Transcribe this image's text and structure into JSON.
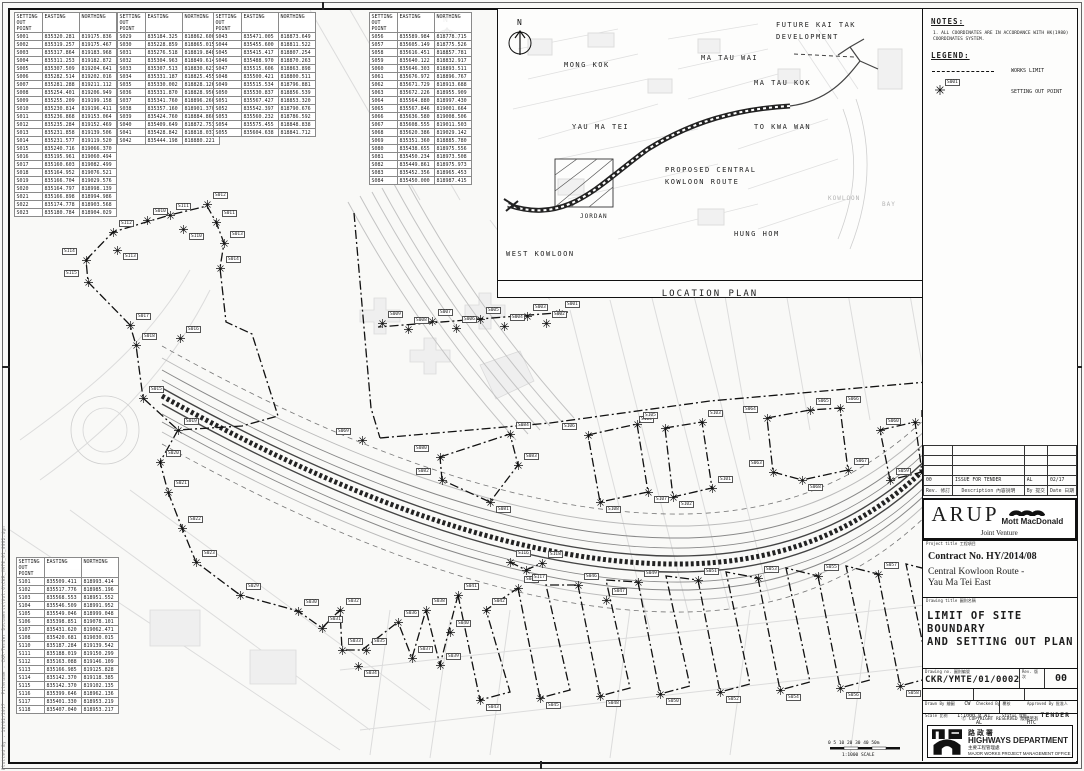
{
  "sheet": {
    "plot_info_line1": "Plotted By : 16/02/2017",
    "plot_info_line2": "Filename : CKR-Tender Documents\\Vol.6\\CKR_YMTE_01_0002.dgn",
    "north_label": "N",
    "scale_bar_ticks": "0  5  10   20   30   40   50m",
    "scale_bar_label": "1:1000  SCALE"
  },
  "tables": {
    "headers": [
      "SETTING OUT POINT",
      "EASTING",
      "NORTHING"
    ],
    "t1": {
      "rows": [
        [
          "S001",
          "835320.281",
          "819175.836"
        ],
        [
          "S002",
          "835319.257",
          "819175.467"
        ],
        [
          "S003",
          "835317.864",
          "819183.968"
        ],
        [
          "S004",
          "835311.253",
          "819182.872"
        ],
        [
          "S005",
          "835307.509",
          "819204.641"
        ],
        [
          "S006",
          "835282.514",
          "819202.016"
        ],
        [
          "S007",
          "835281.288",
          "819211.112"
        ],
        [
          "S008",
          "835254.401",
          "819206.949"
        ],
        [
          "S009",
          "835255.209",
          "819199.158"
        ],
        [
          "S010",
          "835230.814",
          "819196.411"
        ],
        [
          "S011",
          "835236.868",
          "819153.064"
        ],
        [
          "S012",
          "835235.284",
          "819152.469"
        ],
        [
          "S013",
          "835231.858",
          "819139.506"
        ],
        [
          "S014",
          "835231.577",
          "819119.520"
        ],
        [
          "S015",
          "835240.716",
          "819066.370"
        ],
        [
          "S016",
          "835195.961",
          "819060.494"
        ],
        [
          "S017",
          "835160.603",
          "819082.499"
        ],
        [
          "S018",
          "835164.952",
          "819076.521"
        ],
        [
          "S019",
          "835166.704",
          "819029.576"
        ],
        [
          "S020",
          "835164.797",
          "818998.139"
        ],
        [
          "S021",
          "835166.898",
          "818994.986"
        ],
        [
          "S022",
          "835174.778",
          "818903.568"
        ],
        [
          "S023",
          "835180.784",
          "818904.029"
        ]
      ]
    },
    "t2": {
      "rows": [
        [
          "S029",
          "835184.325",
          "818862.600"
        ],
        [
          "S030",
          "835228.859",
          "818865.015"
        ],
        [
          "S031",
          "835276.518",
          "818819.848"
        ],
        [
          "S032",
          "835304.963",
          "818849.614"
        ],
        [
          "S033",
          "835307.513",
          "818830.623"
        ],
        [
          "S034",
          "835331.187",
          "818825.455"
        ],
        [
          "S035",
          "835330.002",
          "818828.126"
        ],
        [
          "S036",
          "835331.870",
          "818828.956"
        ],
        [
          "S037",
          "835341.760",
          "818896.260"
        ],
        [
          "S038",
          "835357.160",
          "818901.370"
        ],
        [
          "S039",
          "835424.760",
          "818884.860"
        ],
        [
          "S040",
          "835409.649",
          "818872.753"
        ],
        [
          "S041",
          "835428.842",
          "818818.037"
        ],
        [
          "S042",
          "835444.198",
          "818880.221"
        ]
      ]
    },
    "t3": {
      "rows": [
        [
          "S043",
          "835471.005",
          "818873.649"
        ],
        [
          "S044",
          "835455.600",
          "818811.522"
        ],
        [
          "S045",
          "835415.417",
          "818807.254"
        ],
        [
          "S046",
          "835488.970",
          "818870.263"
        ],
        [
          "S047",
          "835515.606",
          "818863.898"
        ],
        [
          "S048",
          "835500.421",
          "818800.511"
        ],
        [
          "S049",
          "835515.534",
          "818796.881"
        ],
        [
          "S050",
          "835530.837",
          "818856.539"
        ],
        [
          "S051",
          "835567.427",
          "818853.320"
        ],
        [
          "S052",
          "835542.397",
          "818790.676"
        ],
        [
          "S053",
          "835560.232",
          "818786.592"
        ],
        [
          "S054",
          "835575.455",
          "818848.838"
        ],
        [
          "S055",
          "835604.638",
          "818841.712"
        ]
      ]
    },
    "t4": {
      "rows": [
        [
          "S056",
          "835589.984",
          "818778.715"
        ],
        [
          "S057",
          "835605.149",
          "818775.526"
        ],
        [
          "S058",
          "835616.451",
          "818857.781"
        ],
        [
          "S059",
          "835640.122",
          "818832.917"
        ],
        [
          "S060",
          "835646.303",
          "818893.511"
        ],
        [
          "S061",
          "835676.972",
          "818896.767"
        ],
        [
          "S062",
          "835671.729",
          "818913.688"
        ],
        [
          "S063",
          "835672.226",
          "818955.909"
        ],
        [
          "S064",
          "835564.880",
          "818997.430"
        ],
        [
          "S065",
          "835567.846",
          "819001.664"
        ],
        [
          "S066",
          "835636.580",
          "819008.506"
        ],
        [
          "S067",
          "835608.555",
          "819011.503"
        ],
        [
          "S068",
          "835620.386",
          "819029.142"
        ],
        [
          "S069",
          "835351.360",
          "818885.780"
        ],
        [
          "S080",
          "835438.655",
          "818975.556"
        ],
        [
          "S081",
          "835450.234",
          "818973.508"
        ],
        [
          "S082",
          "835449.861",
          "818975.973"
        ],
        [
          "S083",
          "835452.356",
          "818965.453"
        ],
        [
          "S084",
          "835450.000",
          "818987.415"
        ]
      ]
    },
    "t5": {
      "rows": [
        [
          "S101",
          "835509.411",
          "818993.414"
        ],
        [
          "S102",
          "835517.776",
          "818985.196"
        ],
        [
          "S103",
          "835568.553",
          "818951.552"
        ],
        [
          "S104",
          "835546.509",
          "818991.952"
        ],
        [
          "S105",
          "835549.046",
          "818999.048"
        ],
        [
          "S106",
          "835398.851",
          "819078.101"
        ],
        [
          "S107",
          "835431.620",
          "819062.471"
        ],
        [
          "S108",
          "835420.681",
          "819030.015"
        ],
        [
          "S110",
          "835187.284",
          "819139.542"
        ],
        [
          "S111",
          "835188.019",
          "819150.299"
        ],
        [
          "S112",
          "835163.088",
          "819146.109"
        ],
        [
          "S113",
          "835166.985",
          "819125.828"
        ],
        [
          "S114",
          "835142.370",
          "819118.385"
        ],
        [
          "S115",
          "835142.370",
          "819102.135"
        ],
        [
          "S116",
          "835399.646",
          "818962.136"
        ],
        [
          "S117",
          "835401.330",
          "818953.219"
        ],
        [
          "S118",
          "835407.040",
          "818953.217"
        ]
      ]
    }
  },
  "location_plan": {
    "title": "LOCATION PLAN",
    "labels": [
      {
        "text": "FUTURE KAI TAK",
        "x": 278,
        "y": 12,
        "name": "label-future-kai-tak"
      },
      {
        "text": "DEVELOPMENT",
        "x": 278,
        "y": 24,
        "name": "label-future-kai-tak-2"
      },
      {
        "text": "MONG KOK",
        "x": 66,
        "y": 52,
        "name": "label-mong-kok"
      },
      {
        "text": "MA TAU WAI",
        "x": 203,
        "y": 45,
        "name": "label-ma-tau-wai"
      },
      {
        "text": "MA TAU KOK",
        "x": 256,
        "y": 70,
        "name": "label-ma-tau-kok"
      },
      {
        "text": "YAU MA TEI",
        "x": 74,
        "y": 114,
        "name": "label-yau-ma-tei"
      },
      {
        "text": "TO KWA WAN",
        "x": 256,
        "y": 114,
        "name": "label-to-kwa-wan"
      },
      {
        "text": "PROPOSED CENTRAL",
        "x": 167,
        "y": 157,
        "name": "label-proposed-ckr"
      },
      {
        "text": "KOWLOON ROUTE",
        "x": 167,
        "y": 169,
        "name": "label-proposed-ckr-2"
      },
      {
        "text": "JORDAN",
        "x": 82,
        "y": 204,
        "cls": "small",
        "name": "label-jordan"
      },
      {
        "text": "WEST KOWLOON",
        "x": 8,
        "y": 241,
        "name": "label-west-kowloon"
      },
      {
        "text": "HUNG HOM",
        "x": 236,
        "y": 221,
        "name": "label-hung-hom"
      },
      {
        "text": "KOWLOON",
        "x": 330,
        "y": 186,
        "cls": "faint",
        "name": "label-kowloon"
      },
      {
        "text": "BAY",
        "x": 384,
        "y": 192,
        "cls": "faint",
        "name": "label-bay"
      }
    ]
  },
  "notes_panel": {
    "notes_title": "NOTES:",
    "note1": "1. ALL COORDINATES ARE IN ACCORDANCE WITH HK(1980) COORDINATES SYSTEM.",
    "legend_title": "LEGEND:",
    "works_limit_label": "WORKS LIMIT",
    "setting_out_label": "SETTING OUT POINT",
    "sample_point_id": "S001"
  },
  "title_block": {
    "revision": {
      "rev": "00",
      "description": "ISSUE FOR TENDER",
      "by": "AL",
      "date": "02/17"
    },
    "rev_headers": {
      "rev": "Rev. 修訂",
      "description": "Description 內容說明",
      "by": "By 提交",
      "date": "Date 日期"
    },
    "jv": {
      "arup": "ARUP",
      "mott": "Mott MacDonald",
      "joint_venture": "Joint Venture"
    },
    "project": {
      "label": "Project title 工程項目",
      "contract": "Contract No. HY/2014/08",
      "line1": "Central Kowloon Route -",
      "line2": "Yau Ma Tei East"
    },
    "drawing": {
      "label": "Drawing title 圖則名稱",
      "line1": "LIMIT OF SITE BOUNDARY",
      "line2": "AND SETTING OUT PLAN"
    },
    "numbers": {
      "drawing_no_label": "Drawing no. 圖則編號",
      "drawing_no": "CKR/YMTE/01/0002",
      "rev_label": "Rev. 版次",
      "rev": "00"
    },
    "people": {
      "drawn_label": "Drawn By 繪圖",
      "drawn": "CW",
      "checked_label": "Checked By 覆核",
      "checked": "AL",
      "approved_label": "Approved By 批准人",
      "approved": "HTC"
    },
    "scale_row": {
      "scale_label": "Scale 比例",
      "scale": "1:1000 @ A1",
      "status_label": "Status 狀態",
      "status": "TENDER"
    },
    "copyright": "Ⓒ COPYRIGHT RESERVED 版權所有",
    "department": {
      "cn": "路 政 署",
      "en": "HIGHWAYS DEPARTMENT",
      "office_cn": "主要工程管理處",
      "office_en": "MAJOR WORKS PROJECT MANAGEMENT OFFICE"
    }
  },
  "map": {
    "points": [
      {
        "id": "S001",
        "x": 549,
        "y": 303
      },
      {
        "id": "S002",
        "x": 536,
        "y": 313
      },
      {
        "id": "S003",
        "x": 517,
        "y": 306
      },
      {
        "id": "S004",
        "x": 494,
        "y": 316
      },
      {
        "id": "S005",
        "x": 470,
        "y": 309
      },
      {
        "id": "S006",
        "x": 446,
        "y": 318
      },
      {
        "id": "S007",
        "x": 422,
        "y": 311
      },
      {
        "id": "S008",
        "x": 398,
        "y": 319
      },
      {
        "id": "S009",
        "x": 372,
        "y": 313
      },
      {
        "id": "S010",
        "x": 137,
        "y": 210
      },
      {
        "id": "S011",
        "x": 206,
        "y": 212
      },
      {
        "id": "S012",
        "x": 197,
        "y": 194
      },
      {
        "id": "S013",
        "x": 214,
        "y": 233
      },
      {
        "id": "S014",
        "x": 210,
        "y": 258
      },
      {
        "id": "S015",
        "x": 133,
        "y": 388
      },
      {
        "id": "S016",
        "x": 170,
        "y": 328
      },
      {
        "id": "S017",
        "x": 120,
        "y": 315
      },
      {
        "id": "S018",
        "x": 126,
        "y": 335
      },
      {
        "id": "S019",
        "x": 168,
        "y": 420
      },
      {
        "id": "S020",
        "x": 150,
        "y": 452
      },
      {
        "id": "S021",
        "x": 158,
        "y": 482
      },
      {
        "id": "S022",
        "x": 172,
        "y": 518
      },
      {
        "id": "S023",
        "x": 186,
        "y": 552
      },
      {
        "id": "S110",
        "x": 173,
        "y": 219,
        "dy": 4
      },
      {
        "id": "S111",
        "x": 160,
        "y": 205
      },
      {
        "id": "S112",
        "x": 103,
        "y": 222
      },
      {
        "id": "S113",
        "x": 107,
        "y": 240,
        "dy": 3
      },
      {
        "id": "S114",
        "x": 76,
        "y": 250,
        "dx": -24
      },
      {
        "id": "S115",
        "x": 78,
        "y": 272,
        "dx": -24
      },
      {
        "id": "S029",
        "x": 230,
        "y": 585
      },
      {
        "id": "S030",
        "x": 288,
        "y": 601
      },
      {
        "id": "S031",
        "x": 312,
        "y": 618
      },
      {
        "id": "S032",
        "x": 330,
        "y": 600
      },
      {
        "id": "S033",
        "x": 332,
        "y": 640
      },
      {
        "id": "S034",
        "x": 348,
        "y": 656,
        "dy": 4
      },
      {
        "id": "S035",
        "x": 356,
        "y": 640
      },
      {
        "id": "S036",
        "x": 388,
        "y": 612
      },
      {
        "id": "S037",
        "x": 402,
        "y": 648
      },
      {
        "id": "S038",
        "x": 416,
        "y": 600
      },
      {
        "id": "S039",
        "x": 430,
        "y": 655
      },
      {
        "id": "S040",
        "x": 440,
        "y": 622
      },
      {
        "id": "S041",
        "x": 448,
        "y": 585
      },
      {
        "id": "S042",
        "x": 476,
        "y": 600
      },
      {
        "id": "S043",
        "x": 470,
        "y": 690,
        "dy": 4
      },
      {
        "id": "S044",
        "x": 508,
        "y": 578
      },
      {
        "id": "S045",
        "x": 530,
        "y": 688,
        "dy": 4
      },
      {
        "id": "S046",
        "x": 568,
        "y": 575
      },
      {
        "id": "S047",
        "x": 596,
        "y": 590
      },
      {
        "id": "S048",
        "x": 590,
        "y": 686,
        "dy": 4
      },
      {
        "id": "S049",
        "x": 628,
        "y": 572
      },
      {
        "id": "S050",
        "x": 650,
        "y": 684,
        "dy": 4
      },
      {
        "id": "S051",
        "x": 688,
        "y": 570
      },
      {
        "id": "S052",
        "x": 710,
        "y": 682,
        "dy": 4
      },
      {
        "id": "S053",
        "x": 748,
        "y": 568
      },
      {
        "id": "S054",
        "x": 770,
        "y": 680,
        "dy": 4
      },
      {
        "id": "S055",
        "x": 808,
        "y": 566
      },
      {
        "id": "S056",
        "x": 830,
        "y": 678,
        "dy": 4
      },
      {
        "id": "S057",
        "x": 868,
        "y": 564
      },
      {
        "id": "S058",
        "x": 890,
        "y": 676,
        "dy": 4
      },
      {
        "id": "S059",
        "x": 880,
        "y": 470
      },
      {
        "id": "S060",
        "x": 870,
        "y": 420
      },
      {
        "id": "S061",
        "x": 905,
        "y": 412
      },
      {
        "id": "S062",
        "x": 912,
        "y": 462
      },
      {
        "id": "S063",
        "x": 763,
        "y": 462,
        "dx": -24
      },
      {
        "id": "S064",
        "x": 757,
        "y": 408,
        "dx": -24
      },
      {
        "id": "S065",
        "x": 800,
        "y": 400
      },
      {
        "id": "S066",
        "x": 830,
        "y": 398
      },
      {
        "id": "S067",
        "x": 838,
        "y": 460
      },
      {
        "id": "S068",
        "x": 792,
        "y": 470,
        "dy": 4
      },
      {
        "id": "S069",
        "x": 352,
        "y": 430,
        "dx": -26
      },
      {
        "id": "S080",
        "x": 430,
        "y": 447,
        "dx": -26
      },
      {
        "id": "S081",
        "x": 480,
        "y": 492,
        "dy": 4
      },
      {
        "id": "S082",
        "x": 432,
        "y": 470,
        "dx": -26
      },
      {
        "id": "S083",
        "x": 508,
        "y": 455
      },
      {
        "id": "S084",
        "x": 500,
        "y": 424
      },
      {
        "id": "S101",
        "x": 702,
        "y": 478
      },
      {
        "id": "S102",
        "x": 663,
        "y": 487,
        "dy": 4
      },
      {
        "id": "S103",
        "x": 692,
        "y": 412
      },
      {
        "id": "S104",
        "x": 655,
        "y": 418,
        "dx": -26
      },
      {
        "id": "S105",
        "x": 627,
        "y": 414
      },
      {
        "id": "S106",
        "x": 578,
        "y": 425,
        "dx": -26
      },
      {
        "id": "S107",
        "x": 638,
        "y": 482,
        "dy": 4
      },
      {
        "id": "S108",
        "x": 590,
        "y": 492,
        "dy": 4
      },
      {
        "id": "S116",
        "x": 500,
        "y": 552
      },
      {
        "id": "S117",
        "x": 516,
        "y": 560,
        "dy": 4
      },
      {
        "id": "S118",
        "x": 532,
        "y": 553
      }
    ]
  }
}
